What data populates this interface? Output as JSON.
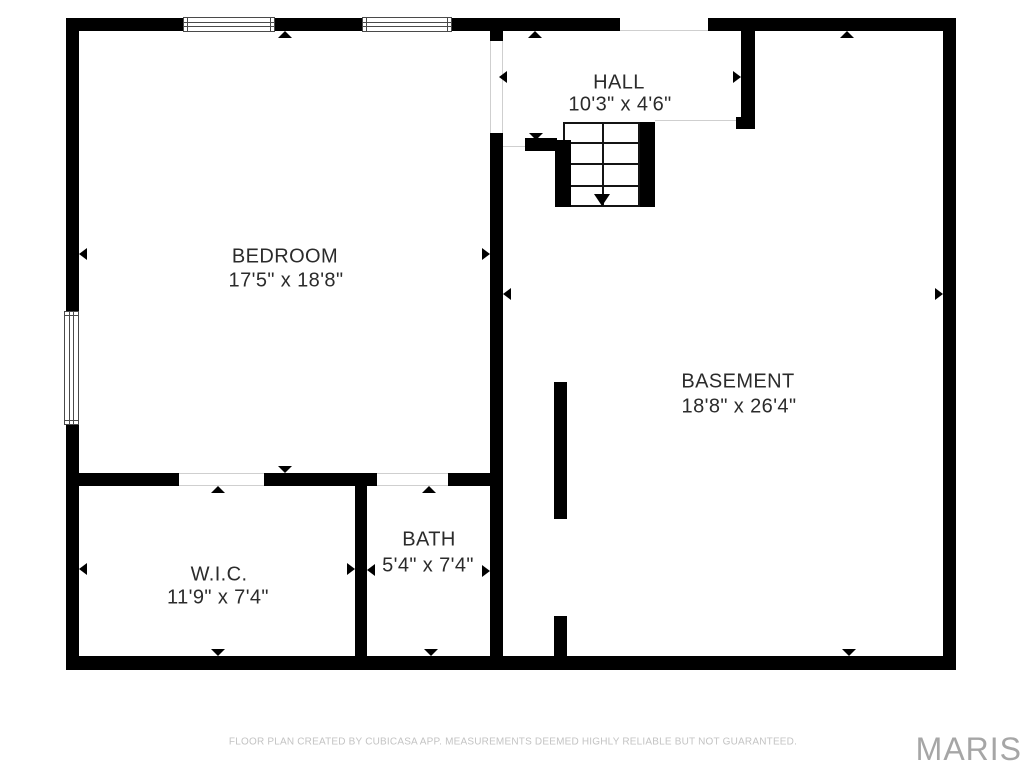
{
  "meta": {
    "width": 1024,
    "height": 768,
    "background": "#ffffff"
  },
  "colors": {
    "wall": "#000000",
    "label_text": "#2b2b2b",
    "thin_line": "#cfcfcf",
    "window_frame": "#4a4a4a",
    "stair_line": "#141414",
    "footer_text": "#c3c3c3",
    "watermark_text": "#a6a6a6"
  },
  "rooms": [
    {
      "key": "hall",
      "name": "HALL",
      "dims": "10'3\" x 4'6\"",
      "name_cx": 619,
      "name_cy": 83,
      "dims_cx": 620,
      "dims_cy": 105
    },
    {
      "key": "bedroom",
      "name": "BEDROOM",
      "dims": "17'5\" x 18'8\"",
      "name_cx": 285,
      "name_cy": 257,
      "dims_cx": 286,
      "dims_cy": 281
    },
    {
      "key": "basement",
      "name": "BASEMENT",
      "dims": "18'8\" x 26'4\"",
      "name_cx": 738,
      "name_cy": 382,
      "dims_cx": 739,
      "dims_cy": 407
    },
    {
      "key": "wic",
      "name": "W.I.C.",
      "dims": "11'9\" x 7'4\"",
      "name_cx": 219,
      "name_cy": 575,
      "dims_cx": 218,
      "dims_cy": 598
    },
    {
      "key": "bath",
      "name": "BATH",
      "dims": "5'4\" x 7'4\"",
      "name_cx": 429,
      "name_cy": 540,
      "dims_cx": 428,
      "dims_cy": 566
    }
  ],
  "walls": [
    {
      "name": "outer-wall-top-left-segment",
      "x": 66,
      "y": 18,
      "w": 554,
      "h": 13
    },
    {
      "name": "outer-wall-top-right-segment",
      "x": 708,
      "y": 18,
      "w": 248,
      "h": 13
    },
    {
      "name": "outer-wall-left-upper",
      "x": 66,
      "y": 18,
      "w": 13,
      "h": 293
    },
    {
      "name": "outer-wall-left-lower",
      "x": 66,
      "y": 425,
      "w": 13,
      "h": 245
    },
    {
      "name": "outer-wall-right",
      "x": 943,
      "y": 18,
      "w": 13,
      "h": 652
    },
    {
      "name": "outer-wall-bottom",
      "x": 66,
      "y": 656,
      "w": 890,
      "h": 14
    },
    {
      "name": "hall-left-wall-stub",
      "x": 490,
      "y": 31,
      "w": 13,
      "h": 10
    },
    {
      "name": "bedroom-basement-divider",
      "x": 490,
      "y": 133,
      "w": 13,
      "h": 523
    },
    {
      "name": "hall-right-wall",
      "x": 741,
      "y": 31,
      "w": 14,
      "h": 87
    },
    {
      "name": "hall-right-wall-foot",
      "x": 736,
      "y": 117,
      "w": 19,
      "h": 12
    },
    {
      "name": "stair-west-wall-segment",
      "x": 525,
      "y": 138,
      "w": 32,
      "h": 13
    },
    {
      "name": "stair-left-bar",
      "x": 555,
      "y": 140,
      "w": 16,
      "h": 67
    },
    {
      "name": "stair-right-bar",
      "x": 640,
      "y": 122,
      "w": 15,
      "h": 85
    },
    {
      "name": "wic-top-wall-west",
      "x": 79,
      "y": 473,
      "w": 100,
      "h": 13
    },
    {
      "name": "wic-top-wall-middle",
      "x": 264,
      "y": 473,
      "w": 113,
      "h": 13
    },
    {
      "name": "bath-top-wall-east",
      "x": 448,
      "y": 473,
      "w": 42,
      "h": 13
    },
    {
      "name": "wic-bath-divider-wall",
      "x": 355,
      "y": 473,
      "w": 12,
      "h": 197
    },
    {
      "name": "basement-partial-wall-upper",
      "x": 554,
      "y": 382,
      "w": 13,
      "h": 137
    },
    {
      "name": "basement-partial-wall-lower",
      "x": 554,
      "y": 616,
      "w": 13,
      "h": 54
    }
  ],
  "windows": [
    {
      "name": "window-top-1",
      "x": 183,
      "y": 17,
      "w": 92,
      "h": 15,
      "orientation": "horizontal"
    },
    {
      "name": "window-top-2",
      "x": 362,
      "y": 17,
      "w": 90,
      "h": 15,
      "orientation": "horizontal"
    },
    {
      "name": "window-left",
      "x": 64,
      "y": 311,
      "w": 15,
      "h": 114,
      "orientation": "vertical"
    }
  ],
  "stairs": {
    "name": "staircase",
    "x": 563,
    "y": 122,
    "w": 77,
    "h": 85,
    "treads_rel_y": [
      20,
      41,
      63
    ],
    "center_rel_x": 39,
    "arrow_dir": "down"
  },
  "thin_lines": [
    {
      "name": "top-wall-opening-line",
      "x": 620,
      "y": 30,
      "w": 88,
      "h": 1
    },
    {
      "name": "hall-door-edge-left",
      "x": 490,
      "y": 40,
      "w": 1,
      "h": 93
    },
    {
      "name": "hall-door-edge-right",
      "x": 502,
      "y": 40,
      "w": 1,
      "h": 93
    },
    {
      "name": "hall-south-boundary",
      "x": 655,
      "y": 120,
      "w": 82,
      "h": 1
    },
    {
      "name": "hall-west-boundary",
      "x": 503,
      "y": 146,
      "w": 23,
      "h": 1
    },
    {
      "name": "wic-door-edge-top",
      "x": 179,
      "y": 473,
      "w": 85,
      "h": 1
    },
    {
      "name": "wic-door-edge-bottom",
      "x": 179,
      "y": 485,
      "w": 85,
      "h": 1
    },
    {
      "name": "bath-door-edge-top",
      "x": 377,
      "y": 473,
      "w": 71,
      "h": 1
    },
    {
      "name": "bath-door-edge-bottom",
      "x": 377,
      "y": 485,
      "w": 71,
      "h": 1
    }
  ],
  "span_arrows": [
    {
      "name": "bedroom-span-arrow-top",
      "dir": "up",
      "x": 278,
      "y": 31
    },
    {
      "name": "bedroom-span-arrow-bottom",
      "dir": "down",
      "x": 278,
      "y": 466
    },
    {
      "name": "bedroom-span-arrow-left",
      "dir": "left",
      "x": 79,
      "y": 248
    },
    {
      "name": "bedroom-span-arrow-right",
      "dir": "right",
      "x": 482,
      "y": 248
    },
    {
      "name": "hall-span-arrow-top",
      "dir": "up",
      "x": 528,
      "y": 31
    },
    {
      "name": "hall-span-arrow-bottom",
      "dir": "down",
      "x": 529,
      "y": 133
    },
    {
      "name": "hall-span-arrow-left",
      "dir": "left",
      "x": 499,
      "y": 71
    },
    {
      "name": "hall-span-arrow-right",
      "dir": "right",
      "x": 733,
      "y": 71
    },
    {
      "name": "basement-span-arrow-top",
      "dir": "up",
      "x": 840,
      "y": 31
    },
    {
      "name": "basement-span-arrow-bottom",
      "dir": "down",
      "x": 842,
      "y": 649
    },
    {
      "name": "basement-span-arrow-left",
      "dir": "left",
      "x": 503,
      "y": 288
    },
    {
      "name": "basement-span-arrow-right",
      "dir": "right",
      "x": 935,
      "y": 288
    },
    {
      "name": "wic-span-arrow-top",
      "dir": "up",
      "x": 211,
      "y": 486
    },
    {
      "name": "wic-span-arrow-bottom",
      "dir": "down",
      "x": 211,
      "y": 649
    },
    {
      "name": "wic-span-arrow-left",
      "dir": "left",
      "x": 79,
      "y": 563
    },
    {
      "name": "wic-span-arrow-right",
      "dir": "right",
      "x": 347,
      "y": 563
    },
    {
      "name": "bath-span-arrow-top",
      "dir": "up",
      "x": 422,
      "y": 486
    },
    {
      "name": "bath-span-arrow-bottom",
      "dir": "down",
      "x": 424,
      "y": 649
    },
    {
      "name": "bath-span-arrow-left",
      "dir": "left",
      "x": 367,
      "y": 564
    },
    {
      "name": "bath-span-arrow-right",
      "dir": "right",
      "x": 482,
      "y": 565
    }
  ],
  "footer": {
    "text": "FLOOR PLAN CREATED BY CUBICASA APP. MEASUREMENTS DEEMED HIGHLY RELIABLE BUT NOT GUARANTEED.",
    "cx": 513,
    "cy": 742
  },
  "watermark": {
    "text": "MARIS",
    "right": 2,
    "top": 731
  }
}
